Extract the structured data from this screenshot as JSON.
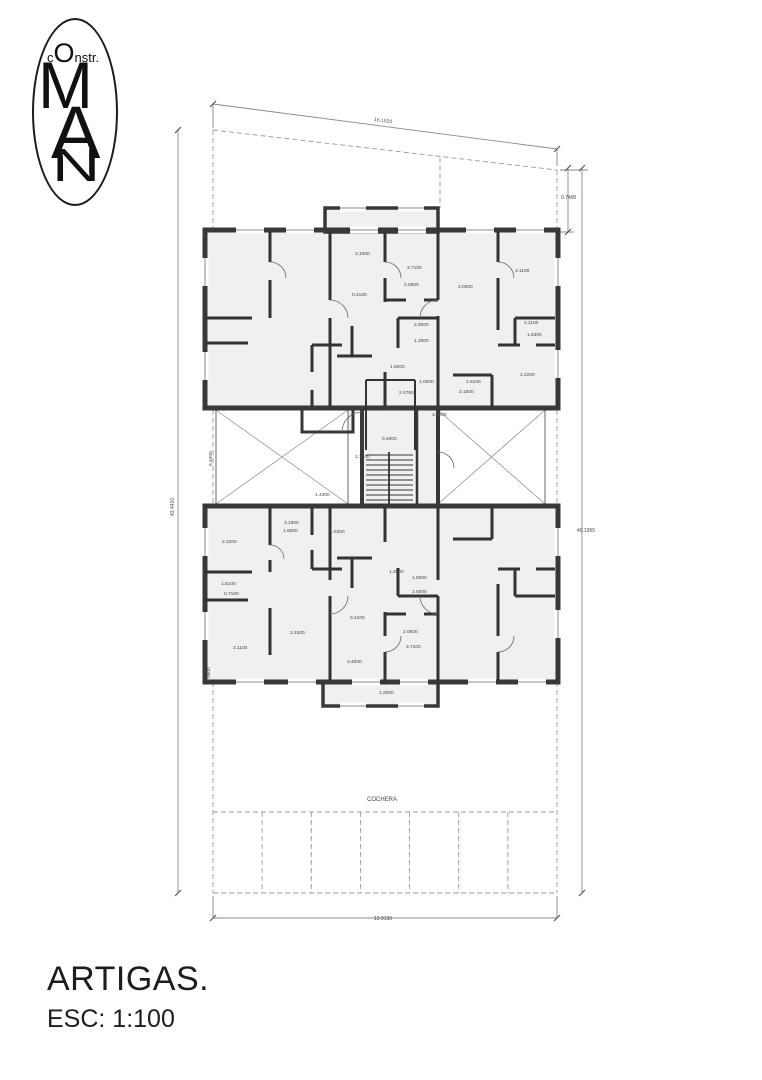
{
  "logo": {
    "prefix": "c",
    "capital_o": "O",
    "suffix": "nstr.",
    "monogram": [
      "M",
      "A",
      "N"
    ]
  },
  "title_block": {
    "project": "ARTIGAS.",
    "scale": "ESC: 1:100"
  },
  "plan": {
    "parking": {
      "stall_count": 7
    },
    "labels": [
      {
        "t": "16.1520",
        "x": 374,
        "y": 121,
        "r": 7,
        "s": 5
      },
      {
        "t": "0.7490",
        "x": 561,
        "y": 199,
        "s": 5
      },
      {
        "t": "40.1955",
        "x": 577,
        "y": 532,
        "s": 5
      },
      {
        "t": "43.4410",
        "x": 174,
        "y": 516,
        "r": -90,
        "s": 5
      },
      {
        "t": "5.4000",
        "x": 212,
        "y": 466,
        "r": -90
      },
      {
        "t": "13.9130",
        "x": 374,
        "y": 920,
        "s": 5
      },
      {
        "t": "COCHERA",
        "x": 367,
        "y": 801,
        "s": 6,
        "n": "parking-label"
      },
      {
        "t": "2.0600",
        "x": 210,
        "y": 682,
        "r": -90
      },
      {
        "t": "3.1600",
        "x": 355,
        "y": 255
      },
      {
        "t": "3.7100",
        "x": 407,
        "y": 269
      },
      {
        "t": "3.0000",
        "x": 458,
        "y": 288
      },
      {
        "t": "3.1100",
        "x": 515,
        "y": 272
      },
      {
        "t": "0.4100",
        "x": 352,
        "y": 296
      },
      {
        "t": "2.0600",
        "x": 404,
        "y": 286
      },
      {
        "t": "2.6000",
        "x": 414,
        "y": 326
      },
      {
        "t": "1.2000",
        "x": 414,
        "y": 342
      },
      {
        "t": "2.1100",
        "x": 524,
        "y": 324
      },
      {
        "t": "1.5300",
        "x": 527,
        "y": 336
      },
      {
        "t": "1.5000",
        "x": 390,
        "y": 368
      },
      {
        "t": "1.2200",
        "x": 520,
        "y": 376
      },
      {
        "t": "1.0000",
        "x": 419,
        "y": 383
      },
      {
        "t": "1.6100",
        "x": 466,
        "y": 383
      },
      {
        "t": "2.1500",
        "x": 459,
        "y": 393
      },
      {
        "t": "2.4750",
        "x": 399,
        "y": 394
      },
      {
        "t": "3.0000",
        "x": 432,
        "y": 416
      },
      {
        "t": "3.0000",
        "x": 383,
        "y": 410
      },
      {
        "t": "0.4000",
        "x": 382,
        "y": 440
      },
      {
        "t": "1.1500",
        "x": 355,
        "y": 458
      },
      {
        "t": "1.4300",
        "x": 315,
        "y": 496
      },
      {
        "t": "3.1900",
        "x": 284,
        "y": 524
      },
      {
        "t": "1.5000",
        "x": 283,
        "y": 532
      },
      {
        "t": "1.6300",
        "x": 330,
        "y": 533
      },
      {
        "t": "2.2200",
        "x": 222,
        "y": 543
      },
      {
        "t": "1.2000",
        "x": 389,
        "y": 573
      },
      {
        "t": "1.5000",
        "x": 412,
        "y": 579
      },
      {
        "t": "2.6000",
        "x": 412,
        "y": 593
      },
      {
        "t": "1.5100",
        "x": 221,
        "y": 585
      },
      {
        "t": "0.7100",
        "x": 224,
        "y": 595
      },
      {
        "t": "0.4100",
        "x": 350,
        "y": 619
      },
      {
        "t": "2.0600",
        "x": 403,
        "y": 633
      },
      {
        "t": "3.1000",
        "x": 290,
        "y": 634
      },
      {
        "t": "3.7100",
        "x": 406,
        "y": 648
      },
      {
        "t": "3.1100",
        "x": 233,
        "y": 649
      },
      {
        "t": "3.4600",
        "x": 347,
        "y": 663
      },
      {
        "t": "1.2000",
        "x": 379,
        "y": 694
      }
    ]
  }
}
